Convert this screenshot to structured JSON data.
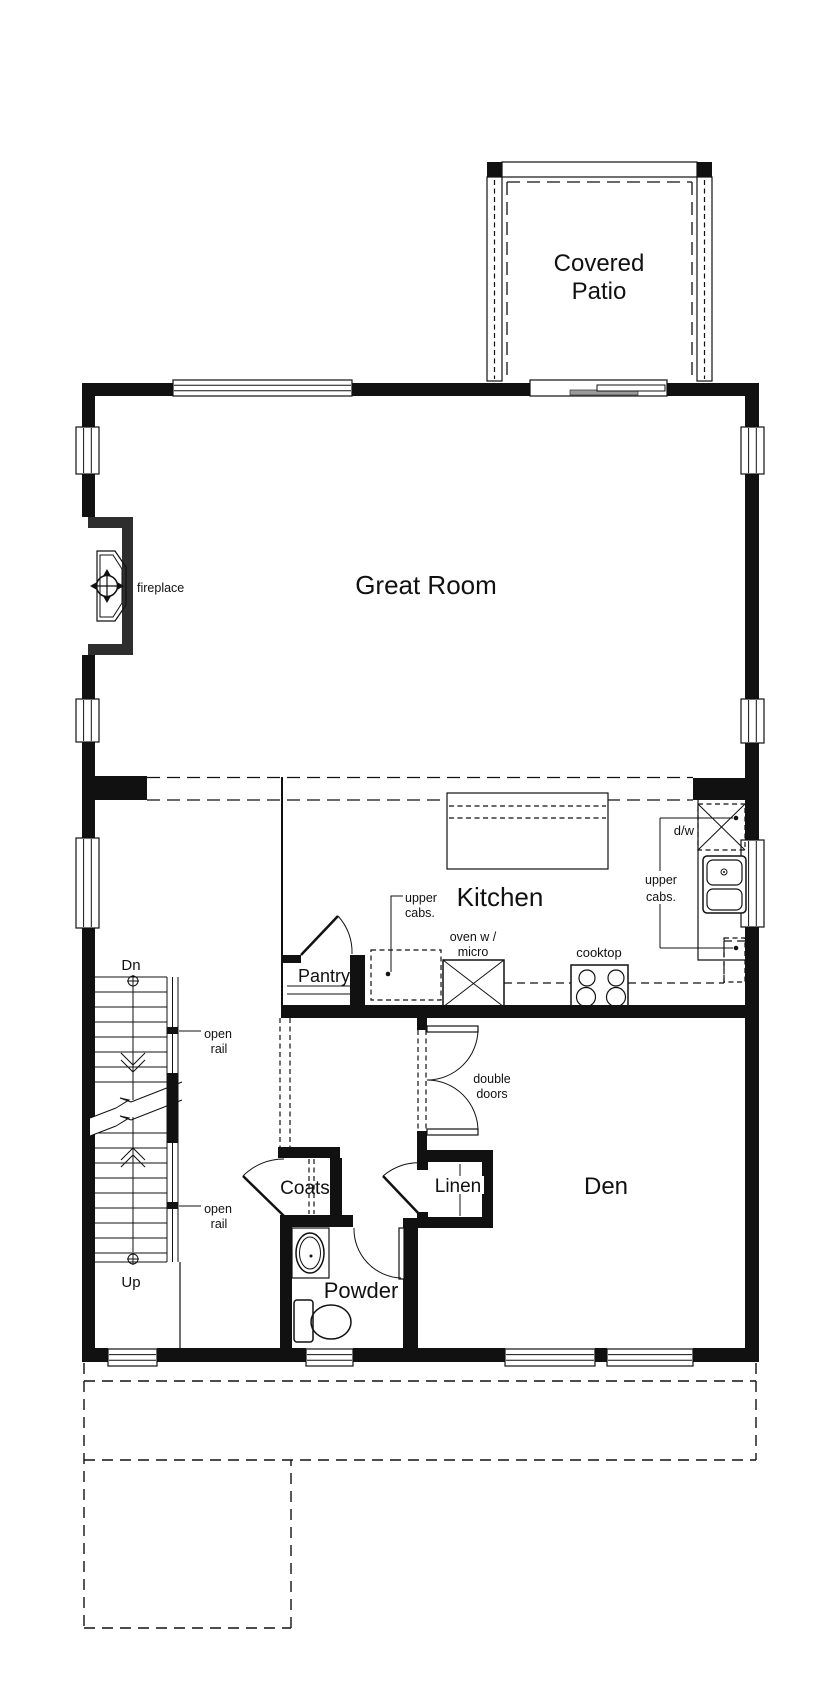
{
  "canvas": {
    "width": 840,
    "height": 1692,
    "background": "#ffffff"
  },
  "colors": {
    "wall": "#111111",
    "line": "#111111",
    "text": "#111111",
    "glass": "#9a9a9a",
    "frame": "#2e2e2e"
  },
  "labels": {
    "covered_patio": [
      "Covered",
      "Patio"
    ],
    "great_room": "Great Room",
    "kitchen": "Kitchen",
    "den": "Den",
    "pantry": "Pantry",
    "coats": "Coats",
    "linen": "Linen",
    "powder": "Powder",
    "fireplace": "fireplace",
    "dishwasher": "d/w",
    "upper_cabs": [
      "upper",
      "cabs."
    ],
    "oven_micro": [
      "oven w /",
      "micro"
    ],
    "cooktop": "cooktop",
    "double_doors": [
      "double",
      "doors"
    ],
    "open_rail": [
      "open",
      "rail"
    ],
    "stairs_down": "Dn",
    "stairs_up": "Up"
  }
}
